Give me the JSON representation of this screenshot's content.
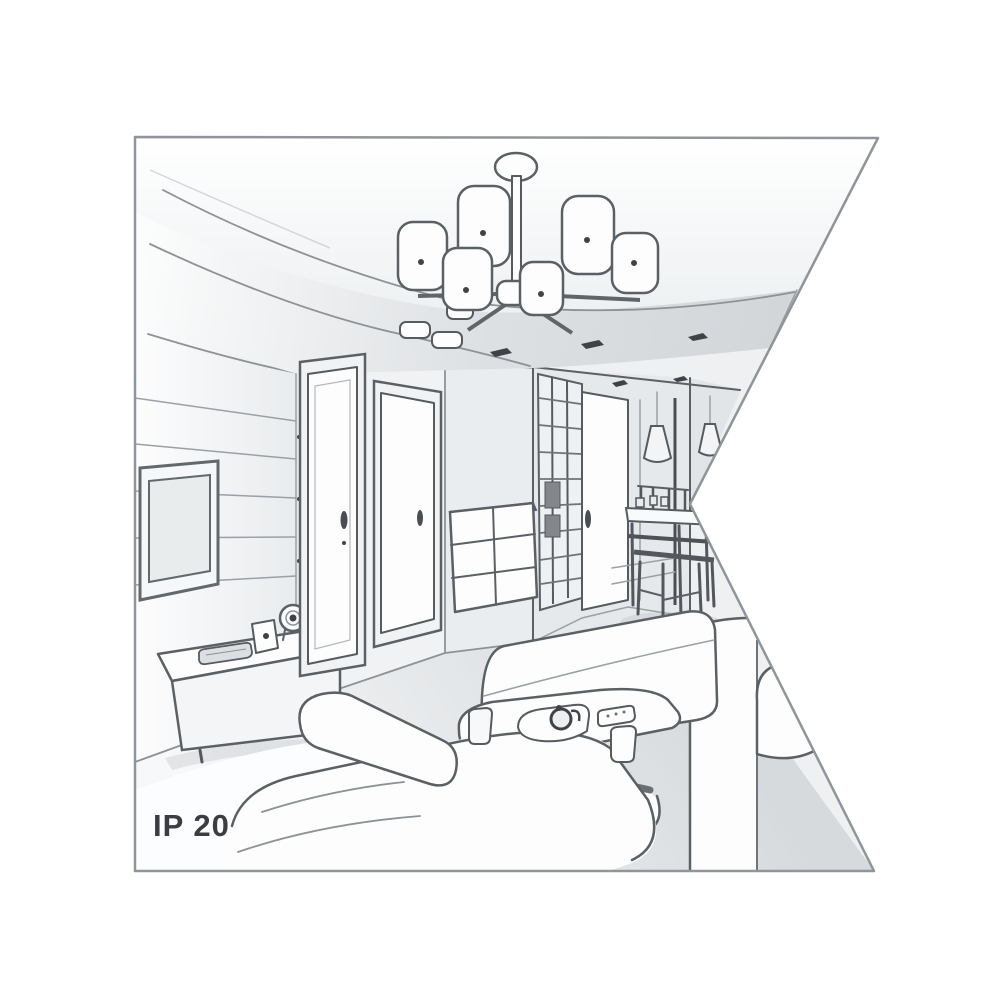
{
  "artwork": {
    "label": "IP 20"
  },
  "colors": {
    "background": "#ffffff",
    "frame_stroke": "#8f959a",
    "line": "#5b6065",
    "line_dark": "#3f4347",
    "wall_light": "#eef0f2",
    "wall_shade": "#d5d9dc",
    "floor": "#dfe2e5",
    "furniture": "#fdfdfe",
    "label_color": "#3a3d42"
  }
}
